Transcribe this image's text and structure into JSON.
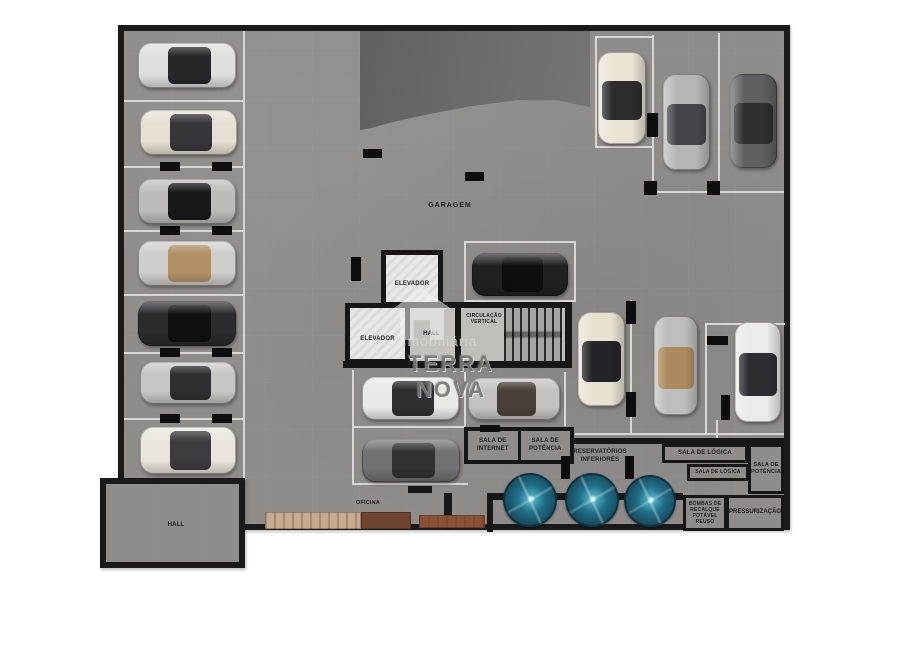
{
  "plan": {
    "garagem_label": "GARAGEM",
    "oficina_label": "OFICINA",
    "hall_annex_label": "HALL"
  },
  "core": {
    "elevator_upper": "ELEVADOR",
    "elevator_lower": "ELEVADOR",
    "hall": "HALL",
    "circulacao": "CIRCULAÇÃO\nVERTICAL"
  },
  "rooms": {
    "sala_internet": "SALA DE\nINTERNET",
    "sala_potencia_center": "SALA DE\nPOTÊNCIA",
    "reservatorios": "RESERVATÓRIOS\nINFERIORES",
    "sala_logica_1": "SALA DE LÓGICA",
    "sala_logica_2": "SALA DE LÓGICA",
    "sala_potencia_right": "SALA DE\nPOTÊNCIA",
    "bombas": "BOMBAS DE\nRECALQUE\nPOTÁVEL REUSO",
    "pressurizacao": "PRESSURIZAÇÃO"
  },
  "watermark": {
    "line_top": "Imobiliária",
    "line_bottom": "TERRA NOVA",
    "logo_icon": "house-icon"
  },
  "colors": {
    "floor": "#8f8c8a",
    "wall": "#171717",
    "parking_line": "#d9d7d3",
    "ramp": "#6d6a67",
    "tank_teal": "#1d5f75",
    "wood_light": "#c6ab90",
    "wood_dark": "#6f4531",
    "wood_red": "#8a5136",
    "hall_floor": "#c4c1bd"
  },
  "floorplan": {
    "lines": [
      [
        243,
        31,
        2,
        452
      ],
      [
        124,
        100,
        119,
        2
      ],
      [
        124,
        166,
        119,
        2
      ],
      [
        124,
        230,
        119,
        2
      ],
      [
        124,
        294,
        119,
        2
      ],
      [
        124,
        352,
        119,
        2
      ],
      [
        124,
        418,
        119,
        2
      ],
      [
        652,
        35,
        2,
        158
      ],
      [
        718,
        33,
        2,
        160
      ],
      [
        595,
        36,
        57,
        2
      ],
      [
        595,
        38,
        2,
        108
      ],
      [
        595,
        146,
        59,
        2
      ],
      [
        650,
        191,
        134,
        2
      ],
      [
        630,
        300,
        2,
        133
      ],
      [
        705,
        323,
        80,
        2
      ],
      [
        705,
        325,
        2,
        108
      ],
      [
        575,
        433,
        209,
        2
      ],
      [
        716,
        420,
        2,
        22
      ],
      [
        352,
        370,
        2,
        58
      ],
      [
        464,
        372,
        2,
        54
      ],
      [
        564,
        372,
        2,
        54
      ],
      [
        352,
        426,
        113,
        2
      ],
      [
        352,
        428,
        2,
        57
      ],
      [
        352,
        483,
        116,
        2
      ]
    ],
    "walls": [
      [
        408,
        302,
        164,
        6
      ],
      [
        343,
        361,
        229,
        7
      ],
      [
        565,
        302,
        7,
        66
      ],
      [
        455,
        302,
        6,
        65
      ],
      [
        548,
        438,
        236,
        6
      ],
      [
        487,
        493,
        196,
        7
      ],
      [
        487,
        493,
        6,
        39
      ],
      [
        444,
        493,
        8,
        37
      ],
      [
        408,
        486,
        24,
        7
      ]
    ],
    "pillars": [
      [
        160,
        162,
        20,
        9
      ],
      [
        212,
        162,
        20,
        9
      ],
      [
        160,
        226,
        20,
        9
      ],
      [
        212,
        226,
        20,
        9
      ],
      [
        160,
        348,
        20,
        9
      ],
      [
        212,
        348,
        20,
        9
      ],
      [
        160,
        414,
        20,
        9
      ],
      [
        212,
        414,
        20,
        9
      ],
      [
        363,
        149,
        19,
        9
      ],
      [
        465,
        172,
        19,
        9
      ],
      [
        351,
        257,
        10,
        24
      ],
      [
        647,
        113,
        11,
        24
      ],
      [
        644,
        181,
        13,
        14
      ],
      [
        707,
        181,
        13,
        14
      ],
      [
        626,
        301,
        10,
        23
      ],
      [
        626,
        392,
        10,
        25
      ],
      [
        707,
        336,
        21,
        9
      ],
      [
        721,
        395,
        9,
        25
      ],
      [
        480,
        425,
        20,
        7
      ],
      [
        561,
        456,
        9,
        23
      ],
      [
        625,
        456,
        9,
        23
      ],
      [
        122,
        508,
        7,
        24
      ]
    ],
    "benches": [
      {
        "x": 265,
        "y": 512,
        "w": 96,
        "h": 17,
        "color": "#c6ab90",
        "grain": true
      },
      {
        "x": 361,
        "y": 512,
        "w": 50,
        "h": 17,
        "color": "#6f4531",
        "grain": false
      },
      {
        "x": 419,
        "y": 515,
        "w": 66,
        "h": 13,
        "color": "#8a5136",
        "grain": true
      }
    ],
    "cars": [
      {
        "x": 138,
        "y": 43,
        "w": 98,
        "h": 45,
        "dir": "h",
        "body": "#dfdfdd",
        "cab": "#27272b",
        "name": "white-car"
      },
      {
        "x": 140,
        "y": 110,
        "w": 97,
        "h": 45,
        "dir": "h",
        "body": "#e6e0d2",
        "cab": "#35353a",
        "name": "cream-car"
      },
      {
        "x": 138,
        "y": 179,
        "w": 98,
        "h": 45,
        "dir": "h",
        "body": "#bdbcba",
        "cab": "#18181b",
        "name": "silver-black-roof-car"
      },
      {
        "x": 138,
        "y": 241,
        "w": 98,
        "h": 45,
        "dir": "h",
        "body": "#cfcecb",
        "cab": "#b29066",
        "name": "convertible-car"
      },
      {
        "x": 138,
        "y": 301,
        "w": 98,
        "h": 45,
        "dir": "h",
        "body": "#2b2b2e",
        "cab": "#101013",
        "name": "black-car"
      },
      {
        "x": 140,
        "y": 362,
        "w": 96,
        "h": 42,
        "dir": "h",
        "body": "#c8c6c4",
        "cab": "#2e2e33",
        "name": "silver-car"
      },
      {
        "x": 140,
        "y": 427,
        "w": 96,
        "h": 47,
        "dir": "h",
        "body": "#eae6db",
        "cab": "#3b3b40",
        "name": "cream-suv"
      },
      {
        "x": 598,
        "y": 52,
        "w": 48,
        "h": 92,
        "dir": "v",
        "body": "#eae4d5",
        "cab": "#2c2c30",
        "name": "cream-car"
      },
      {
        "x": 663,
        "y": 74,
        "w": 47,
        "h": 96,
        "dir": "v",
        "body": "#b7b6b4",
        "cab": "#44444a",
        "name": "silver-car"
      },
      {
        "x": 730,
        "y": 74,
        "w": 47,
        "h": 94,
        "dir": "v",
        "body": "#606062",
        "cab": "#2f2f33",
        "name": "dark-gray-car"
      },
      {
        "x": 472,
        "y": 253,
        "w": 96,
        "h": 43,
        "dir": "h",
        "body": "#212124",
        "cab": "#0e0e11",
        "name": "black-suv"
      },
      {
        "x": 578,
        "y": 312,
        "w": 47,
        "h": 94,
        "dir": "v",
        "body": "#e8e2d3",
        "cab": "#242428",
        "name": "cream-car"
      },
      {
        "x": 654,
        "y": 316,
        "w": 44,
        "h": 99,
        "dir": "v",
        "body": "#bfbebc",
        "cab": "#ad8a5e",
        "name": "convertible-car"
      },
      {
        "x": 735,
        "y": 322,
        "w": 46,
        "h": 100,
        "dir": "v",
        "body": "#ebebe9",
        "cab": "#2d2d32",
        "name": "white-car"
      },
      {
        "x": 362,
        "y": 377,
        "w": 97,
        "h": 43,
        "dir": "h",
        "body": "#e9e9e7",
        "cab": "#2e2e33",
        "name": "white-car"
      },
      {
        "x": 468,
        "y": 378,
        "w": 92,
        "h": 42,
        "dir": "h",
        "body": "#c3c2c0",
        "cab": "#4a4038",
        "name": "silver-car"
      },
      {
        "x": 362,
        "y": 439,
        "w": 98,
        "h": 43,
        "dir": "h",
        "body": "#717173",
        "cab": "#313134",
        "name": "gray-car"
      }
    ],
    "tanks": [
      {
        "cx": 530,
        "cy": 500,
        "r": 27
      },
      {
        "cx": 592,
        "cy": 500,
        "r": 27
      },
      {
        "cx": 650,
        "cy": 501,
        "r": 26
      }
    ]
  }
}
